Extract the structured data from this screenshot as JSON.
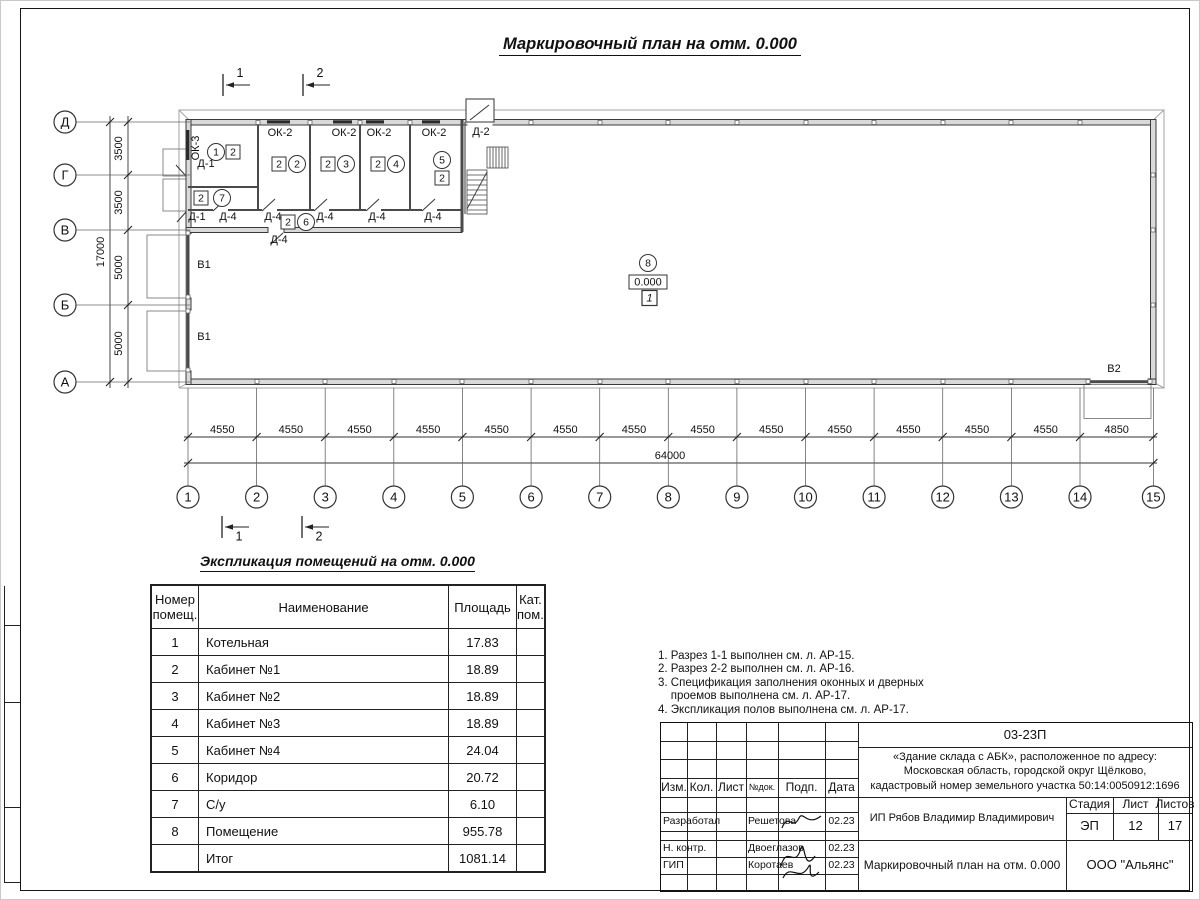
{
  "page": {
    "title": "Маркировочный план на отм. 0.000",
    "table_title": "Экспликация помещений на отм. 0.000"
  },
  "plan": {
    "row_axes": [
      {
        "label": "Д",
        "y": 122
      },
      {
        "label": "Г",
        "y": 175
      },
      {
        "label": "В",
        "y": 230
      },
      {
        "label": "Б",
        "y": 305
      },
      {
        "label": "А",
        "y": 382
      }
    ],
    "row_dims": [
      {
        "text": "3500",
        "y": 148.5
      },
      {
        "text": "3500",
        "y": 202.5
      },
      {
        "text": "5000",
        "y": 267.5
      },
      {
        "text": "5000",
        "y": 343.5
      }
    ],
    "row_total": {
      "text": "17000",
      "y": 252
    },
    "col_axes": [
      {
        "label": "1",
        "x": 188
      },
      {
        "label": "2",
        "x": 256.6
      },
      {
        "label": "3",
        "x": 325.2
      },
      {
        "label": "4",
        "x": 393.8
      },
      {
        "label": "5",
        "x": 462.4
      },
      {
        "label": "6",
        "x": 531.1
      },
      {
        "label": "7",
        "x": 599.7
      },
      {
        "label": "8",
        "x": 668.3
      },
      {
        "label": "9",
        "x": 736.9
      },
      {
        "label": "10",
        "x": 805.5
      },
      {
        "label": "11",
        "x": 874.1
      },
      {
        "label": "12",
        "x": 942.7
      },
      {
        "label": "13",
        "x": 1011.4
      },
      {
        "label": "14",
        "x": 1080
      },
      {
        "label": "15",
        "x": 1153.4
      }
    ],
    "col_dims": [
      {
        "text": "4550",
        "x": 222.3
      },
      {
        "text": "4550",
        "x": 290.9
      },
      {
        "text": "4550",
        "x": 359.5
      },
      {
        "text": "4550",
        "x": 428.1
      },
      {
        "text": "4550",
        "x": 496.7
      },
      {
        "text": "4550",
        "x": 565.4
      },
      {
        "text": "4550",
        "x": 634.0
      },
      {
        "text": "4550",
        "x": 702.6
      },
      {
        "text": "4550",
        "x": 771.2
      },
      {
        "text": "4550",
        "x": 839.8
      },
      {
        "text": "4550",
        "x": 908.4
      },
      {
        "text": "4550",
        "x": 977.0
      },
      {
        "text": "4550",
        "x": 1045.7
      },
      {
        "text": "4850",
        "x": 1116.7
      }
    ],
    "col_total": {
      "text": "64000",
      "x": 670
    },
    "section_marks": [
      {
        "text": "1",
        "x": 223,
        "pos": "top"
      },
      {
        "text": "2",
        "x": 303,
        "pos": "top"
      },
      {
        "text": "1",
        "x": 222,
        "pos": "bottom"
      },
      {
        "text": "2",
        "x": 302,
        "pos": "bottom"
      }
    ],
    "annotations": [
      {
        "kind": "circle",
        "text": "1",
        "x": 216,
        "y": 152
      },
      {
        "kind": "square",
        "text": "2",
        "x": 233,
        "y": 152
      },
      {
        "kind": "square",
        "text": "2",
        "x": 279,
        "y": 164
      },
      {
        "kind": "circle",
        "text": "2",
        "x": 297,
        "y": 164
      },
      {
        "kind": "square",
        "text": "2",
        "x": 328,
        "y": 164
      },
      {
        "kind": "circle",
        "text": "3",
        "x": 346,
        "y": 164
      },
      {
        "kind": "square",
        "text": "2",
        "x": 378,
        "y": 164
      },
      {
        "kind": "circle",
        "text": "4",
        "x": 396,
        "y": 164
      },
      {
        "kind": "circle",
        "text": "5",
        "x": 442,
        "y": 160
      },
      {
        "kind": "square",
        "text": "2",
        "x": 442,
        "y": 178
      },
      {
        "kind": "square",
        "text": "2",
        "x": 201,
        "y": 198
      },
      {
        "kind": "circle",
        "text": "7",
        "x": 222,
        "y": 198
      },
      {
        "kind": "square",
        "text": "2",
        "x": 288,
        "y": 222
      },
      {
        "kind": "circle",
        "text": "6",
        "x": 306,
        "y": 222
      },
      {
        "kind": "circle",
        "text": "8",
        "x": 648,
        "y": 263
      },
      {
        "kind": "elevation",
        "text": "0.000",
        "x": 648,
        "y": 282
      },
      {
        "kind": "zone",
        "text": "1",
        "x": 649.5,
        "y": 298
      },
      {
        "kind": "label",
        "text": "ОК-3",
        "x": 199,
        "y": 148,
        "rotate": -90
      },
      {
        "kind": "label",
        "text": "Д-1",
        "x": 206,
        "y": 167
      },
      {
        "kind": "label",
        "text": "Д-1",
        "x": 197,
        "y": 220
      },
      {
        "kind": "label",
        "text": "Д-4",
        "x": 228,
        "y": 220
      },
      {
        "kind": "label",
        "text": "Д-4",
        "x": 273,
        "y": 220
      },
      {
        "kind": "label",
        "text": "Д-4",
        "x": 325,
        "y": 220
      },
      {
        "kind": "label",
        "text": "Д-4",
        "x": 377,
        "y": 220
      },
      {
        "kind": "label",
        "text": "Д-4",
        "x": 433,
        "y": 220
      },
      {
        "kind": "label",
        "text": "Д-4",
        "x": 279,
        "y": 243
      },
      {
        "kind": "label",
        "text": "ОК-2",
        "x": 280,
        "y": 136
      },
      {
        "kind": "label",
        "text": "ОК-2",
        "x": 344,
        "y": 136
      },
      {
        "kind": "label",
        "text": "ОК-2",
        "x": 379,
        "y": 136
      },
      {
        "kind": "label",
        "text": "ОК-2",
        "x": 434,
        "y": 136
      },
      {
        "kind": "label",
        "text": "Д-2",
        "x": 481,
        "y": 135
      },
      {
        "kind": "label",
        "text": "В1",
        "x": 204,
        "y": 268
      },
      {
        "kind": "label",
        "text": "В1",
        "x": 204,
        "y": 340
      },
      {
        "kind": "label",
        "text": "В2",
        "x": 1114,
        "y": 372
      }
    ]
  },
  "table": {
    "headers": [
      "Номер помещ.",
      "Наименование",
      "Площадь",
      "Кат. пом."
    ],
    "rows": [
      {
        "num": "1",
        "name": "Котельная",
        "area": "17.83",
        "cat": ""
      },
      {
        "num": "2",
        "name": "Кабинет №1",
        "area": "18.89",
        "cat": ""
      },
      {
        "num": "3",
        "name": "Кабинет №2",
        "area": "18.89",
        "cat": ""
      },
      {
        "num": "4",
        "name": "Кабинет №3",
        "area": "18.89",
        "cat": ""
      },
      {
        "num": "5",
        "name": "Кабинет №4",
        "area": "24.04",
        "cat": ""
      },
      {
        "num": "6",
        "name": "Коридор",
        "area": "20.72",
        "cat": ""
      },
      {
        "num": "7",
        "name": "С/у",
        "area": "6.10",
        "cat": ""
      },
      {
        "num": "8",
        "name": "Помещение",
        "area": "955.78",
        "cat": ""
      },
      {
        "num": "",
        "name": "Итог",
        "area": "1081.14",
        "cat": ""
      }
    ]
  },
  "notes": {
    "lines": [
      "1. Разрез 1-1 выполнен см. л. АР-15.",
      "2. Разрез 2-2 выполнен см. л. АР-16.",
      "3. Спецификация заполнения оконных и дверных",
      "    проемов выполнена см. л. АР-17.",
      "4. Экспликация полов выполнена см. л. АР-17."
    ]
  },
  "stamp": {
    "code": "03-23П",
    "object_lines": [
      "«Здание склада с АБК», расположенное по адресу:",
      "Московская область, городской округ Щёлково,",
      "кадастровый номер земельного участка 50:14:0050912:1696"
    ],
    "rev_headers": [
      "Изм.",
      "Кол.",
      "Лист",
      "№док.",
      "Подп.",
      "Дата"
    ],
    "people": [
      {
        "role": "Разработал",
        "name": "Решетова",
        "date": "02.23"
      },
      {
        "role": "Н. контр.",
        "name": "Двоеглазов",
        "date": "02.23"
      },
      {
        "role": "ГИП",
        "name": "Коротаев",
        "date": "02.23"
      }
    ],
    "client": "ИП Рябов Владимир Владимирович",
    "stage_headers": [
      "Стадия",
      "Лист",
      "Листов"
    ],
    "stage_values": [
      "ЭП",
      "12",
      "17"
    ],
    "sheet_name": "Маркировочный план на отм. 0.000",
    "company": "ООО \"Альянс\""
  }
}
